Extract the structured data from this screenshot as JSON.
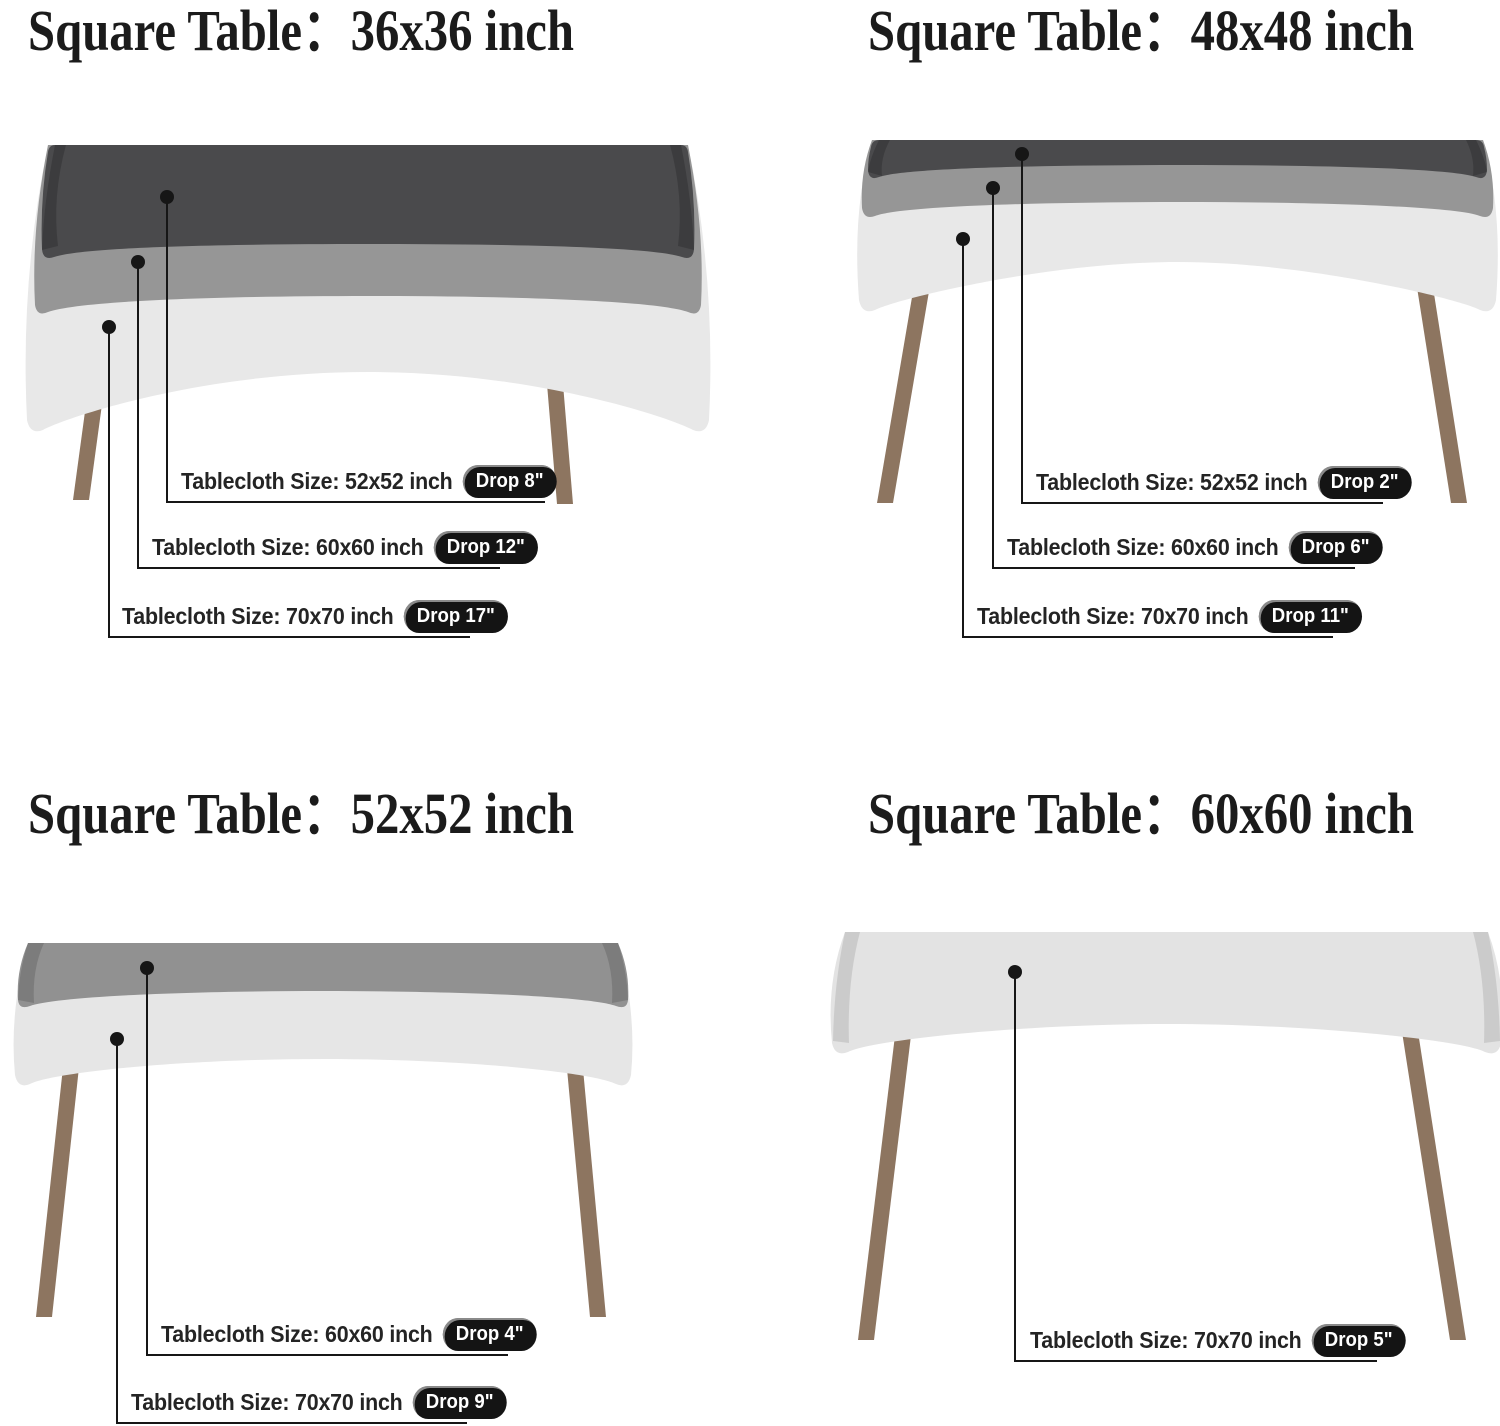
{
  "colors": {
    "cloth_dark": "#4a4a4c",
    "cloth_medium": "#969696",
    "cloth_light": "#e8e8e8",
    "cloth_gray": "#919191",
    "leg_brown": "#8d7560",
    "line": "#161616",
    "badge_bg": "#141414",
    "badge_text": "#ffffff"
  },
  "quadrants": [
    {
      "title": "Square Table：36x36 inch",
      "callouts": [
        {
          "label": "Tablecloth Size: 52x52 inch",
          "drop": "Drop 8\""
        },
        {
          "label": "Tablecloth Size: 60x60 inch",
          "drop": "Drop 12\""
        },
        {
          "label": "Tablecloth Size: 70x70 inch",
          "drop": "Drop 17\""
        }
      ]
    },
    {
      "title": "Square Table：48x48 inch",
      "callouts": [
        {
          "label": "Tablecloth Size: 52x52 inch",
          "drop": "Drop 2\""
        },
        {
          "label": "Tablecloth Size: 60x60 inch",
          "drop": "Drop 6\""
        },
        {
          "label": "Tablecloth Size: 70x70 inch",
          "drop": "Drop 11\""
        }
      ]
    },
    {
      "title": "Square Table：52x52 inch",
      "callouts": [
        {
          "label": "Tablecloth Size: 60x60 inch",
          "drop": "Drop 4\""
        },
        {
          "label": "Tablecloth Size: 70x70 inch",
          "drop": "Drop 9\""
        }
      ]
    },
    {
      "title": "Square Table：60x60 inch",
      "callouts": [
        {
          "label": "Tablecloth Size: 70x70 inch",
          "drop": "Drop 5\""
        }
      ]
    }
  ]
}
